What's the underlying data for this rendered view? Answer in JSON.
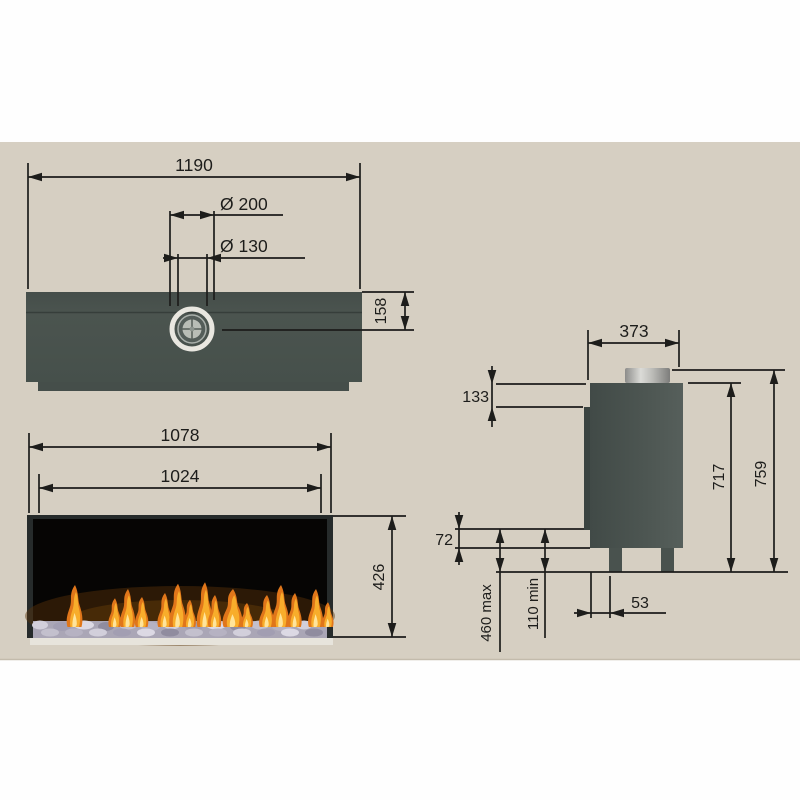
{
  "colors": {
    "canvas": "#d6cfc2",
    "margin": "#fefefe",
    "unit_body": "#4a534f",
    "line": "#1d1d1b",
    "flame_orange": "#e0761a",
    "flame_yellow": "#f8ad2b",
    "pebble_grey": "#b3afc0"
  },
  "top_view": {
    "width": "1190",
    "flue_outer_diameter": "Ø 200",
    "flue_inner_diameter": "Ø 130",
    "flue_center_offset": "158"
  },
  "front_view": {
    "overall_width": "1078",
    "opening_width": "1024",
    "opening_height": "426"
  },
  "side_view": {
    "depth": "373",
    "top_section_height": "133",
    "body_height": "717",
    "overall_height": "759",
    "bottom_panel_height": "72",
    "floor_clearance_max": "460 max",
    "floor_clearance_min": "110 min",
    "leg_inset": "53"
  }
}
